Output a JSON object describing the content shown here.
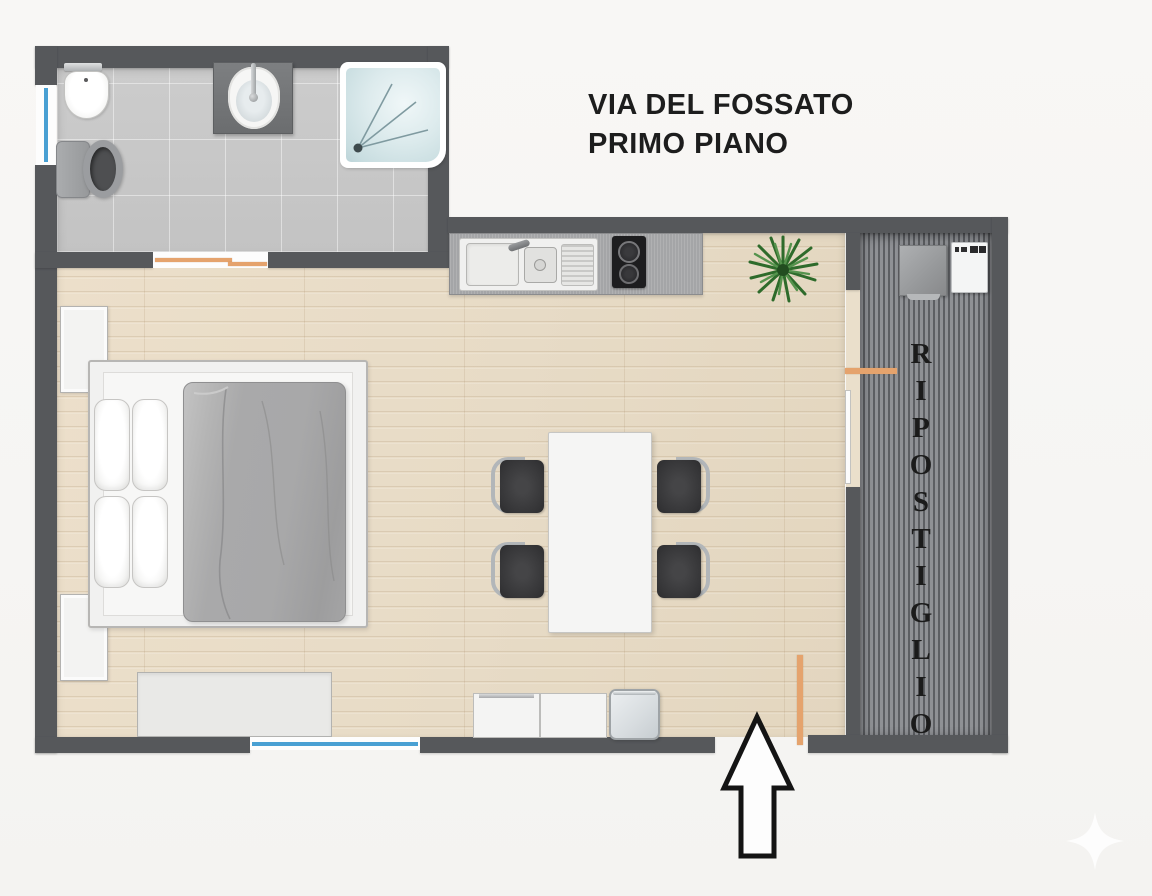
{
  "title": {
    "line1": "VIA DEL FOSSATO",
    "line2": "PRIMO PIANO"
  },
  "storage_room": {
    "label": "RIPOSTIGLIO"
  },
  "icons": {
    "entrance_arrow": "up-arrow-outline",
    "watermark": "four-point-star",
    "plant": "potted-plant-top-view"
  },
  "colors": {
    "background": "#f6f5f3",
    "wall": "#56585b",
    "wood_floor": "#e9decb",
    "tile_floor": "#c9c9c9",
    "storage_floor_light": "#8f9195",
    "storage_floor_dark": "#5d5f63",
    "door_accent_orange": "#e5a36d",
    "window_blue": "#49a0d3",
    "duvet_gray": "#a9a9aa",
    "plant_green": "#3f7d3a",
    "counter_gray": "#a4a5a7"
  }
}
